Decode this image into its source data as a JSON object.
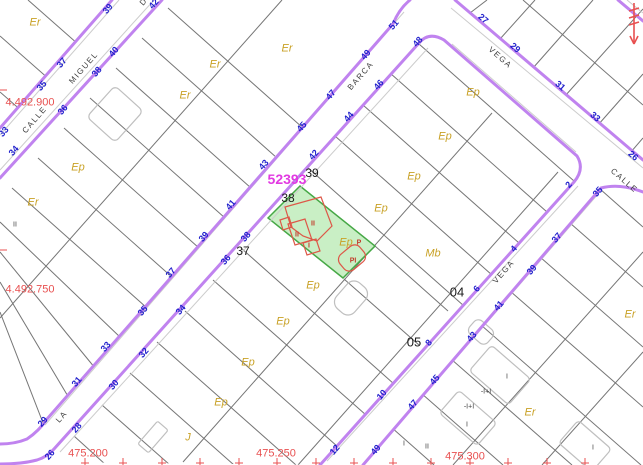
{
  "map": {
    "block_number": {
      "t": "52393",
      "x": 287,
      "y": 179
    },
    "street_names": [
      {
        "t": "CALLE",
        "x": 35,
        "y": 120,
        "r": -49
      },
      {
        "t": "MIGUEL",
        "x": 84,
        "y": 68,
        "r": -49
      },
      {
        "t": "D",
        "x": 144,
        "y": 2,
        "r": -49
      },
      {
        "t": "BARCA",
        "x": 361,
        "y": 76,
        "r": -49
      },
      {
        "t": "LA",
        "x": 62,
        "y": 417,
        "r": -49
      },
      {
        "t": "VEGA",
        "x": 500,
        "y": 58,
        "r": 41
      },
      {
        "t": "VEGA",
        "x": 504,
        "y": 272,
        "r": -49
      },
      {
        "t": "CALLE",
        "x": 624,
        "y": 181,
        "r": 41
      }
    ],
    "house_numbers": [
      {
        "t": "33",
        "x": 4,
        "y": 132,
        "r": -49
      },
      {
        "t": "35",
        "x": 42,
        "y": 86,
        "r": -49
      },
      {
        "t": "37",
        "x": 62,
        "y": 63,
        "r": -49
      },
      {
        "t": "39",
        "x": 108,
        "y": 9,
        "r": -49
      },
      {
        "t": "34",
        "x": 14,
        "y": 151,
        "r": -49
      },
      {
        "t": "36",
        "x": 63,
        "y": 110,
        "r": -49
      },
      {
        "t": "38",
        "x": 97,
        "y": 72,
        "r": -49
      },
      {
        "t": "40",
        "x": 114,
        "y": 52,
        "r": -49
      },
      {
        "t": "42",
        "x": 154,
        "y": 4,
        "r": -49
      },
      {
        "t": "29",
        "x": 43,
        "y": 422,
        "r": -49
      },
      {
        "t": "31",
        "x": 77,
        "y": 382,
        "r": -49
      },
      {
        "t": "33",
        "x": 106,
        "y": 347,
        "r": -49
      },
      {
        "t": "35",
        "x": 143,
        "y": 311,
        "r": -49
      },
      {
        "t": "37",
        "x": 171,
        "y": 273,
        "r": -49
      },
      {
        "t": "39",
        "x": 204,
        "y": 237,
        "r": -49
      },
      {
        "t": "41",
        "x": 231,
        "y": 205,
        "r": -49
      },
      {
        "t": "43",
        "x": 264,
        "y": 165,
        "r": -49
      },
      {
        "t": "45",
        "x": 302,
        "y": 127,
        "r": -49
      },
      {
        "t": "47",
        "x": 331,
        "y": 95,
        "r": -49
      },
      {
        "t": "49",
        "x": 366,
        "y": 55,
        "r": -49
      },
      {
        "t": "51",
        "x": 394,
        "y": 25,
        "r": -49
      },
      {
        "t": "26",
        "x": 50,
        "y": 455,
        "r": -49
      },
      {
        "t": "28",
        "x": 77,
        "y": 428,
        "r": -49
      },
      {
        "t": "30",
        "x": 114,
        "y": 385,
        "r": -49
      },
      {
        "t": "32",
        "x": 144,
        "y": 353,
        "r": -49
      },
      {
        "t": "34",
        "x": 181,
        "y": 310,
        "r": -49
      },
      {
        "t": "36",
        "x": 226,
        "y": 260,
        "r": -49
      },
      {
        "t": "38",
        "x": 246,
        "y": 237,
        "r": -49
      },
      {
        "t": "42",
        "x": 314,
        "y": 155,
        "r": -49
      },
      {
        "t": "44",
        "x": 349,
        "y": 117,
        "r": -49
      },
      {
        "t": "46",
        "x": 379,
        "y": 85,
        "r": -49
      },
      {
        "t": "48",
        "x": 418,
        "y": 42,
        "r": -49
      },
      {
        "t": "27",
        "x": 483,
        "y": 19,
        "r": 41
      },
      {
        "t": "29",
        "x": 515,
        "y": 48,
        "r": 41
      },
      {
        "t": "31",
        "x": 560,
        "y": 86,
        "r": 41
      },
      {
        "t": "33",
        "x": 595,
        "y": 117,
        "r": 41
      },
      {
        "t": "26",
        "x": 633,
        "y": 156,
        "r": 41
      },
      {
        "t": "2",
        "x": 569,
        "y": 185,
        "r": -49
      },
      {
        "t": "4",
        "x": 514,
        "y": 249,
        "r": -49
      },
      {
        "t": "6",
        "x": 477,
        "y": 289,
        "r": -49
      },
      {
        "t": "8",
        "x": 429,
        "y": 343,
        "r": -49
      },
      {
        "t": "10",
        "x": 382,
        "y": 395,
        "r": -49
      },
      {
        "t": "12",
        "x": 335,
        "y": 450,
        "r": -49
      },
      {
        "t": "35",
        "x": 598,
        "y": 192,
        "r": -49
      },
      {
        "t": "37",
        "x": 557,
        "y": 238,
        "r": -49
      },
      {
        "t": "39",
        "x": 532,
        "y": 270,
        "r": -49
      },
      {
        "t": "41",
        "x": 499,
        "y": 306,
        "r": -49
      },
      {
        "t": "43",
        "x": 472,
        "y": 337,
        "r": -49
      },
      {
        "t": "45",
        "x": 435,
        "y": 380,
        "r": -49
      },
      {
        "t": "47",
        "x": 413,
        "y": 405,
        "r": -49
      },
      {
        "t": "49",
        "x": 376,
        "y": 450,
        "r": -49
      }
    ],
    "parcel_numbers": [
      {
        "t": "37",
        "x": 243,
        "y": 251
      },
      {
        "t": "38",
        "x": 288,
        "y": 198
      },
      {
        "t": "39",
        "x": 312,
        "y": 173
      },
      {
        "t": "04",
        "x": 457,
        "y": 292,
        "big": true
      },
      {
        "t": "05",
        "x": 414,
        "y": 342,
        "big": true
      }
    ],
    "land_use_labels": [
      {
        "t": "Er",
        "x": 35,
        "y": 23
      },
      {
        "t": "Er",
        "x": 287,
        "y": 49
      },
      {
        "t": "Er",
        "x": 215,
        "y": 65
      },
      {
        "t": "Er",
        "x": 185,
        "y": 96
      },
      {
        "t": "Er",
        "x": 33,
        "y": 203
      },
      {
        "t": "Er",
        "x": 630,
        "y": 315
      },
      {
        "t": "Er",
        "x": 530,
        "y": 413
      },
      {
        "t": "Ep",
        "x": 78,
        "y": 168
      },
      {
        "t": "Ep",
        "x": 414,
        "y": 177
      },
      {
        "t": "Ep",
        "x": 381,
        "y": 209
      },
      {
        "t": "Ep",
        "x": 346,
        "y": 243
      },
      {
        "t": "Ep",
        "x": 473,
        "y": 93
      },
      {
        "t": "Ep",
        "x": 445,
        "y": 137
      },
      {
        "t": "Ep",
        "x": 313,
        "y": 286
      },
      {
        "t": "Ep",
        "x": 283,
        "y": 322
      },
      {
        "t": "Ep",
        "x": 248,
        "y": 363
      },
      {
        "t": "Ep",
        "x": 221,
        "y": 403
      },
      {
        "t": "Mb",
        "x": 433,
        "y": 254
      },
      {
        "t": "J",
        "x": 188,
        "y": 438
      }
    ],
    "building_labels": [
      {
        "t": "II",
        "x": 313,
        "y": 224,
        "c": "red"
      },
      {
        "t": "II",
        "x": 297,
        "y": 235,
        "c": "red"
      },
      {
        "t": "I",
        "x": 309,
        "y": 246,
        "c": "red"
      },
      {
        "t": "PI",
        "x": 353,
        "y": 261,
        "c": "red"
      },
      {
        "t": "P",
        "x": 359,
        "y": 243,
        "c": "red"
      },
      {
        "t": "I",
        "x": 507,
        "y": 377,
        "c": "black"
      },
      {
        "t": "-I+I",
        "x": 486,
        "y": 392,
        "c": "black"
      },
      {
        "t": "-I+I",
        "x": 469,
        "y": 407,
        "c": "black"
      },
      {
        "t": "I",
        "x": 467,
        "y": 425,
        "c": "black"
      },
      {
        "t": "II",
        "x": 427,
        "y": 447,
        "c": "black"
      },
      {
        "t": "I",
        "x": 404,
        "y": 444,
        "c": "black"
      },
      {
        "t": "I",
        "x": 593,
        "y": 448,
        "c": "black"
      },
      {
        "t": "II",
        "x": 15,
        "y": 225,
        "c": "black"
      }
    ],
    "coordinate_labels": [
      {
        "t": "4.492.900",
        "x": 30,
        "y": 103
      },
      {
        "t": "4.492.750",
        "x": 30,
        "y": 290
      },
      {
        "t": "475.200",
        "x": 88,
        "y": 454
      },
      {
        "t": "475.250",
        "x": 276,
        "y": 454
      },
      {
        "t": "475.300",
        "x": 465,
        "y": 457
      }
    ],
    "grid_ticks": {
      "bottom_y": 461,
      "bottom_xs": [
        85,
        123,
        162,
        200,
        239,
        277,
        316,
        354,
        393,
        431,
        470,
        508,
        547,
        585
      ],
      "left_x": 3,
      "left_ys": [
        90,
        250
      ]
    },
    "icons": {
      "top_right": "red-survey-marker-icon"
    },
    "colors": {
      "street": "#c083ef",
      "blue": "#2121cc",
      "olive": "#c9a227",
      "magenta": "#e23ae2",
      "red": "#e85050",
      "green": "#c9efc5",
      "greenStroke": "#46a846",
      "bred": "#dd5848",
      "pline": "#757575",
      "gbldg": "#bfbfbf"
    }
  }
}
